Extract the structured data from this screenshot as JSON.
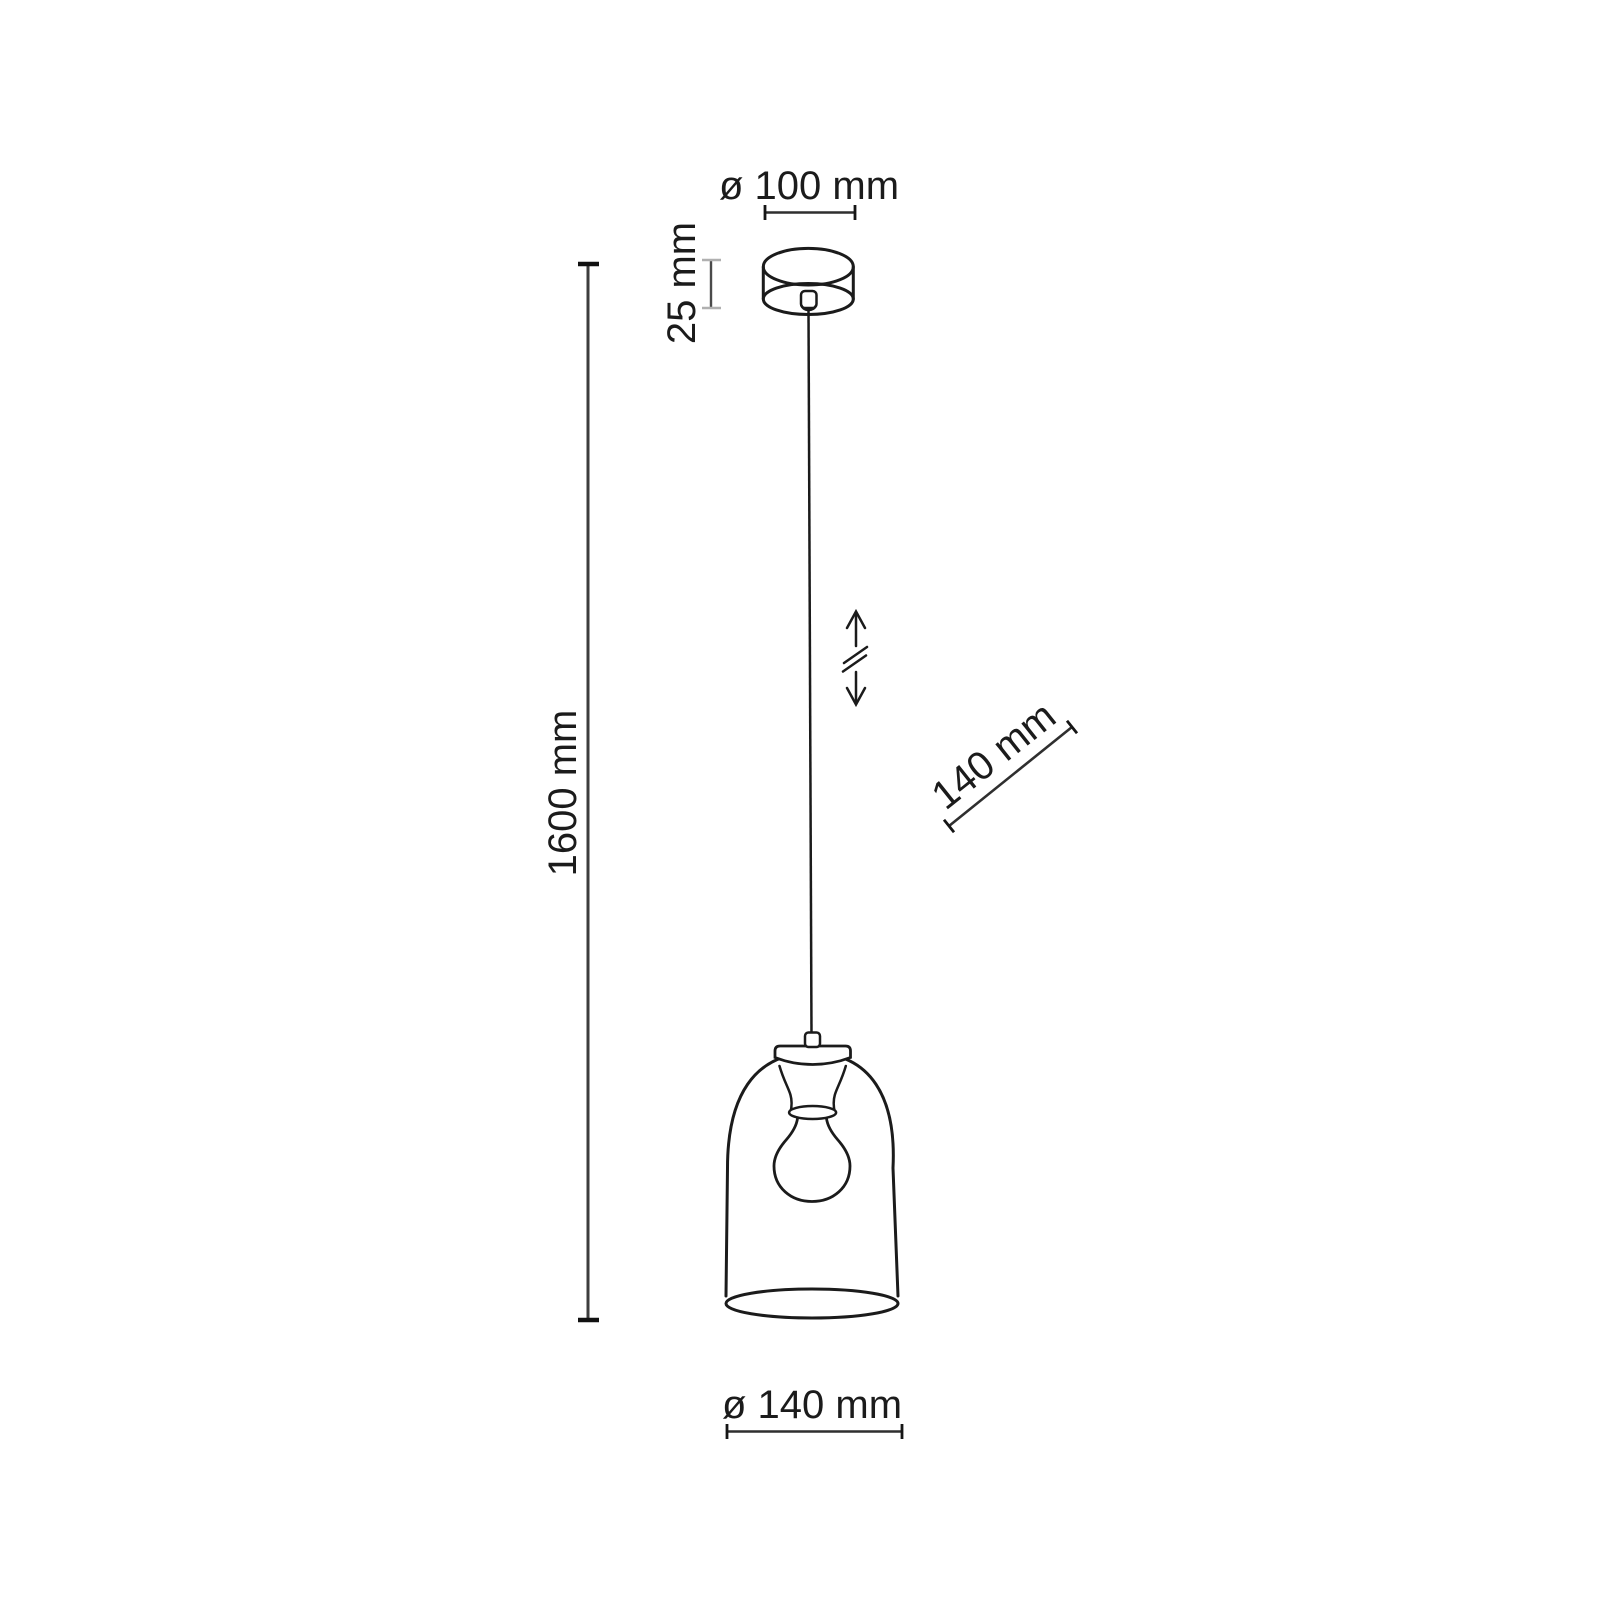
{
  "page": {
    "title": "Pendant lamp dimension drawing",
    "background_color": "#ffffff",
    "line_color": "#1b1b1b"
  },
  "dimensions": {
    "canopy_diameter": {
      "label": "ø 100 mm"
    },
    "canopy_height": {
      "label": "25 mm"
    },
    "overall_height": {
      "label": "1600 mm"
    },
    "diagonal": {
      "label": "140 mm"
    },
    "shade_diameter": {
      "label": "ø 140 mm"
    }
  },
  "symbols": {
    "adjustable_height": "double-arrow-with-break"
  }
}
